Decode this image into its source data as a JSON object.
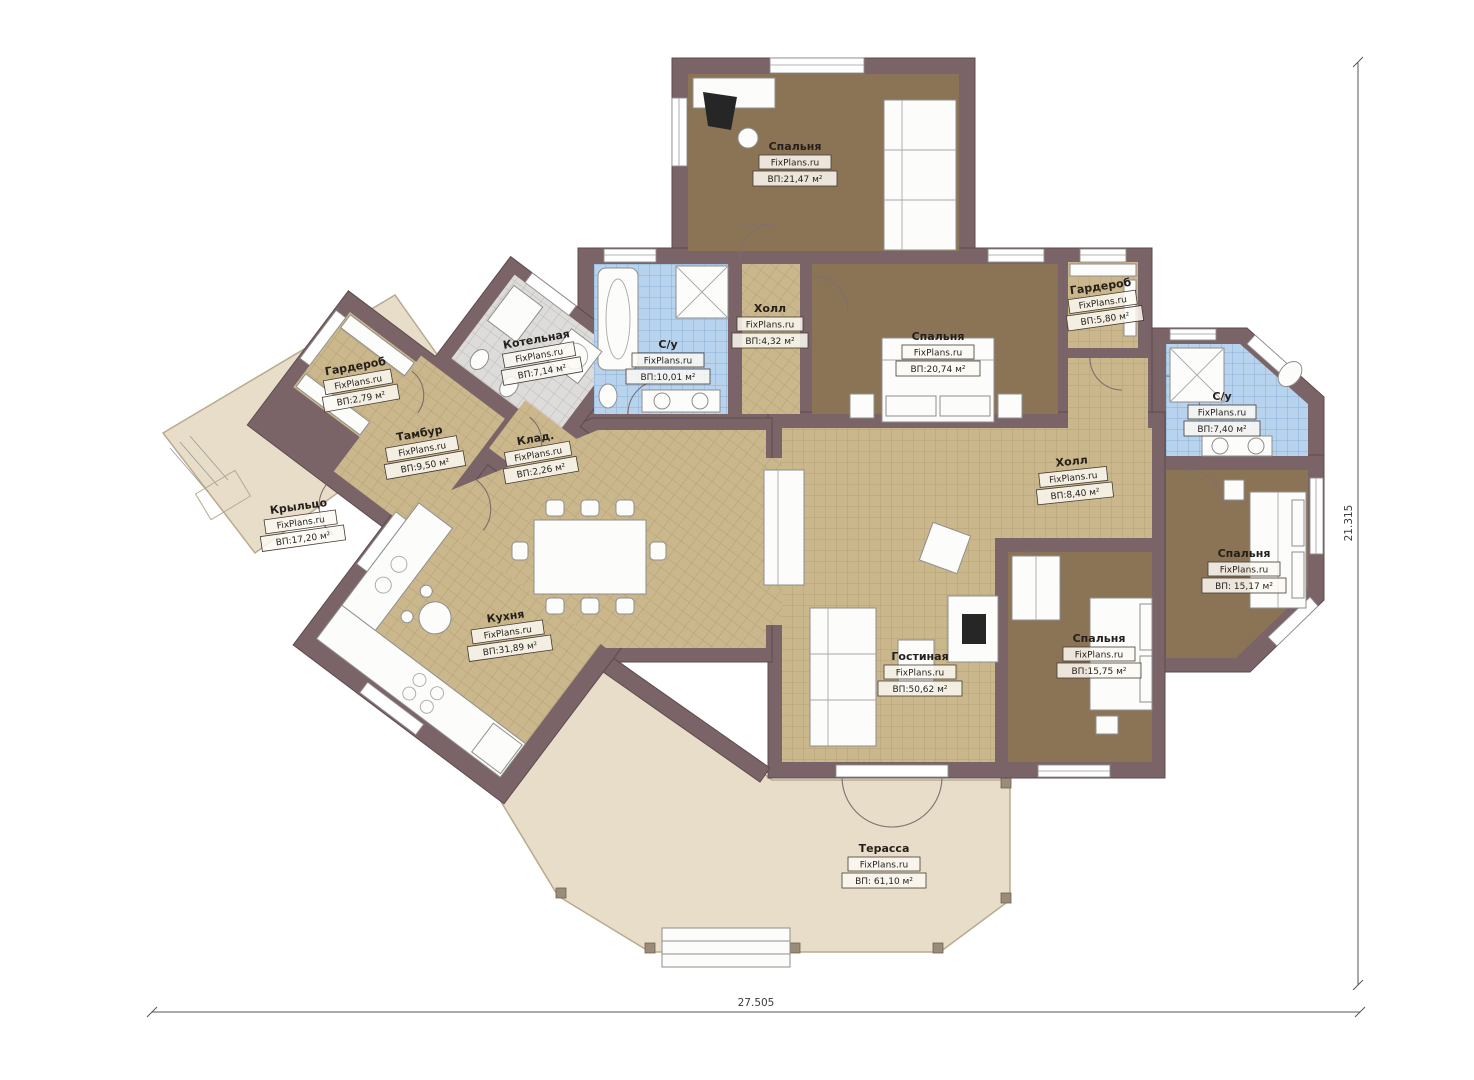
{
  "plan": {
    "brand": "FixPlans.ru",
    "rooms": [
      {
        "id": "bedroom-top",
        "name": "Спальня",
        "brand": "FixPlans.ru",
        "area": "ВП:21,47 м²"
      },
      {
        "id": "bathroom-left",
        "name": "С/у",
        "brand": "FixPlans.ru",
        "area": "ВП:10,01 м²"
      },
      {
        "id": "hall-small",
        "name": "Холл",
        "brand": "FixPlans.ru",
        "area": "ВП:4,32 м²"
      },
      {
        "id": "bedroom-middle",
        "name": "Спальня",
        "brand": "FixPlans.ru",
        "area": "ВП:20,74 м²"
      },
      {
        "id": "wardrobe-right",
        "name": "Гардероб",
        "brand": "FixPlans.ru",
        "area": "ВП:5,80 м²"
      },
      {
        "id": "boiler-room",
        "name": "Котельная",
        "brand": "FixPlans.ru",
        "area": "ВП:7,14 м²"
      },
      {
        "id": "wardrobe-left",
        "name": "Гардероб",
        "brand": "FixPlans.ru",
        "area": "ВП:2,79 м²"
      },
      {
        "id": "vestibule",
        "name": "Тамбур",
        "brand": "FixPlans.ru",
        "area": "ВП:9,50 м²"
      },
      {
        "id": "storage",
        "name": "Клад.",
        "brand": "FixPlans.ru",
        "area": "ВП:2,26 м²"
      },
      {
        "id": "porch",
        "name": "Крыльцо",
        "brand": "FixPlans.ru",
        "area": "ВП:17,20 м²"
      },
      {
        "id": "kitchen",
        "name": "Кухня",
        "brand": "FixPlans.ru",
        "area": "ВП:31,89 м²"
      },
      {
        "id": "living-room",
        "name": "Гостиная",
        "brand": "FixPlans.ru",
        "area": "ВП:50,62 м²"
      },
      {
        "id": "hall-right",
        "name": "Холл",
        "brand": "FixPlans.ru",
        "area": "ВП:8,40 м²"
      },
      {
        "id": "bathroom-right",
        "name": "С/у",
        "brand": "FixPlans.ru",
        "area": "ВП:7,40 м²"
      },
      {
        "id": "bedroom-right",
        "name": "Спальня",
        "brand": "FixPlans.ru",
        "area": "ВП: 15,17 м²"
      },
      {
        "id": "bedroom-bottom",
        "name": "Спальня",
        "brand": "FixPlans.ru",
        "area": "ВП:15,75 м²"
      },
      {
        "id": "terrace",
        "name": "Терасса",
        "brand": "FixPlans.ru",
        "area": "ВП: 61,10 м²"
      }
    ],
    "dimensions": {
      "bottom_label": "27.505",
      "right_label": "21.315"
    },
    "colors": {
      "wall": "#7b6467",
      "bedroom_floor": "#8b7456",
      "tile_tan": "#cbb78c",
      "tile_blue": "#b7d3ee",
      "tile_gray": "#dddcda",
      "terrace": "#e8ddc8",
      "background": "#ffffff"
    }
  }
}
